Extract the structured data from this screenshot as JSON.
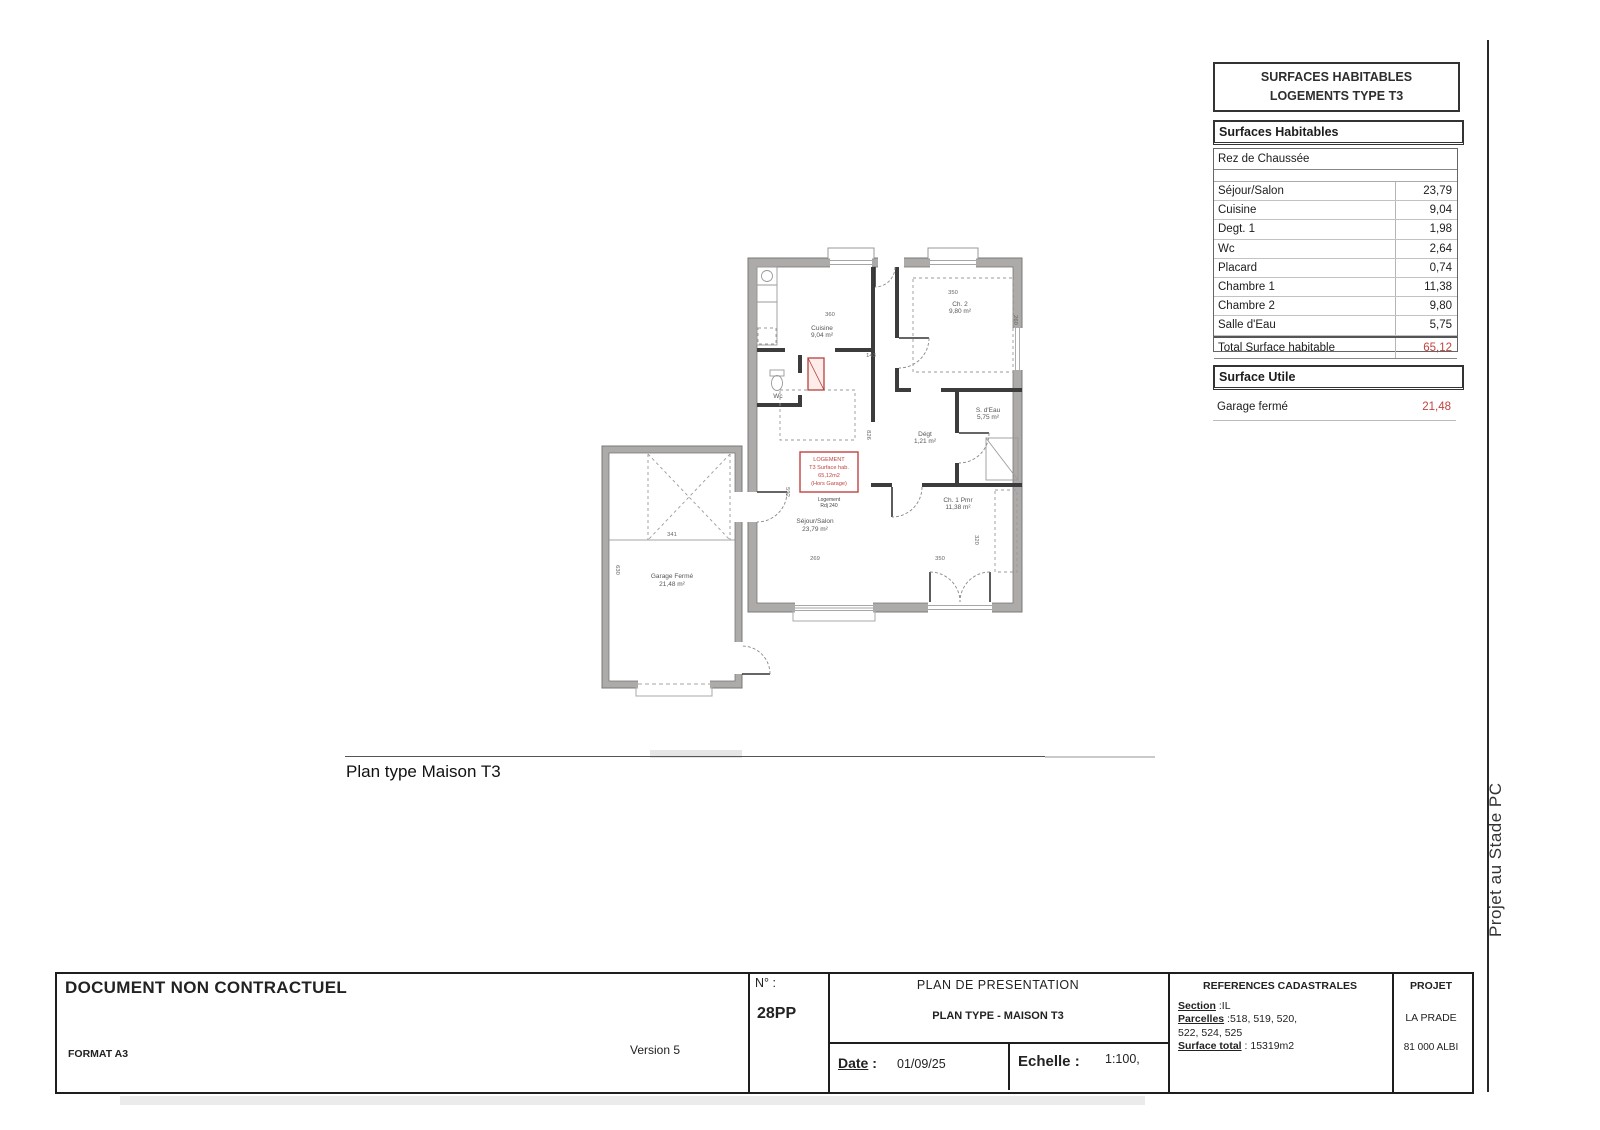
{
  "side_note": "Projet au Stade PC",
  "surfaces_panel": {
    "title_line1": "SURFACES HABITABLES",
    "title_line2": "LOGEMENTS  TYPE T3",
    "section1_header": "Surfaces Habitables",
    "floor_label": "Rez de Chaussée",
    "rows": [
      {
        "label": "Séjour/Salon",
        "value": "23,79"
      },
      {
        "label": "Cuisine",
        "value": "9,04"
      },
      {
        "label": "Degt. 1",
        "value": "1,98"
      },
      {
        "label": "Wc",
        "value": "2,64"
      },
      {
        "label": "Placard",
        "value": "0,74"
      },
      {
        "label": "Chambre 1",
        "value": "11,38"
      },
      {
        "label": "Chambre 2",
        "value": "9,80"
      },
      {
        "label": "Salle d'Eau",
        "value": "5,75"
      }
    ],
    "total_label": "Total Surface habitable",
    "total_value": "65,12",
    "section2_header": "Surface Utile",
    "garage_label": "Garage fermé",
    "garage_value": "21,48",
    "accent_color": "#c0433f"
  },
  "plan": {
    "caption": "Plan  type Maison T3",
    "red_box_lines": [
      "LOGEMENT",
      "T3 Surface hab.",
      "65,12m2",
      "(Hors Garage)"
    ],
    "sub_label_line1": "Logement",
    "sub_label_line2": "Rdj 240",
    "rooms": [
      {
        "name": "Cuisine",
        "area": "9,04 m²"
      },
      {
        "name": "Ch. 2",
        "area": "9,80 m²"
      },
      {
        "name": "Wc",
        "area": "2,64 m²"
      },
      {
        "name": "Dégt",
        "area": "1,21 m²"
      },
      {
        "name": "S. d'Eau",
        "area": "5,75 m²"
      },
      {
        "name": "Ch. 1 Pmr",
        "area": "11,38 m²"
      },
      {
        "name": "Séjour/Salon",
        "area": "23,79 m²"
      },
      {
        "name": "Garage Fermé",
        "area": "21,48 m²"
      }
    ],
    "dims": [
      "360",
      "143",
      "350",
      "260",
      "826",
      "592",
      "269",
      "350",
      "320",
      "341",
      "630"
    ]
  },
  "title_block": {
    "doc_title": "DOCUMENT NON CONTRACTUEL",
    "format": "FORMAT A3",
    "version": "Version 5",
    "number_label": "N° :",
    "number_value": "28PP",
    "plan_title": "PLAN DE PRESENTATION",
    "plan_subtitle": "PLAN TYPE - MAISON T3",
    "date_label": "Date",
    "date_colon": ":",
    "date_value": "01/09/25",
    "scale_label": "Echelle :",
    "scale_value": "1:100,",
    "cadastral_header": "REFERENCES CADASTRALES",
    "section_label": "Section",
    "section_value": " :IL",
    "parcelles_label": "Parcelles",
    "parcelles_value": " :518, 519, 520,",
    "parcelles_value2": "522, 524, 525",
    "surface_label": "Surface total",
    "surface_value": " : 15319m2",
    "project_header": "PROJET",
    "project_name": "LA PRADE",
    "project_city": "81 000 ALBI"
  }
}
